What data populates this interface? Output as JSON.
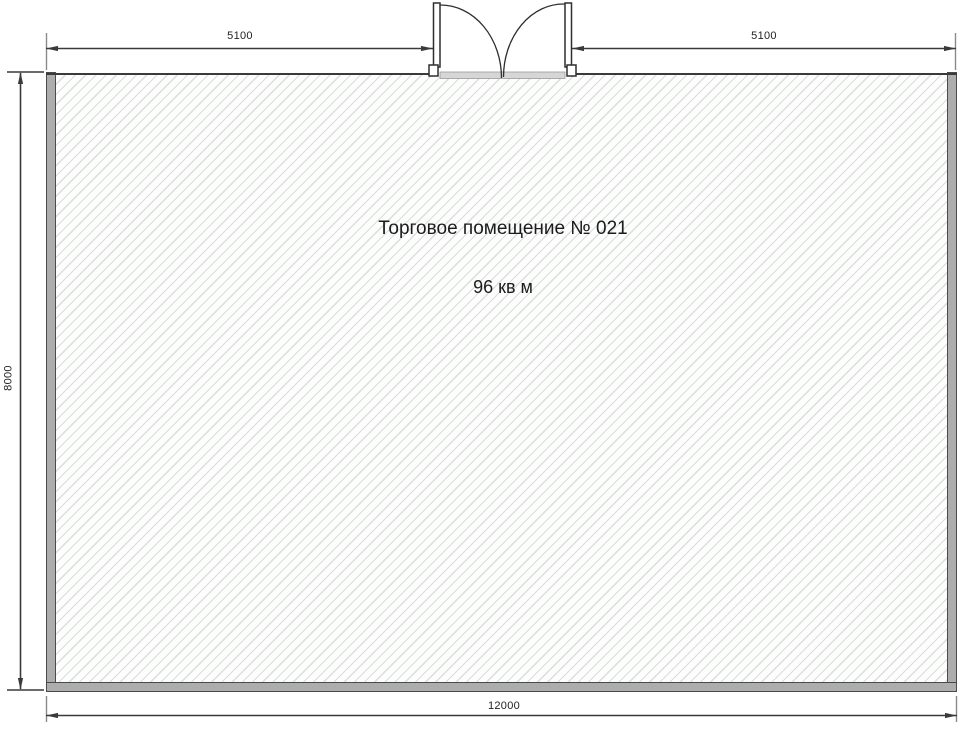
{
  "plan": {
    "title": "Торговое помещение № 021",
    "area": "96 кв м",
    "dimensions": {
      "top_left": "5100",
      "top_right": "5100",
      "left_height": "8000",
      "bottom_width": "12000"
    },
    "colors": {
      "wall_fill": "#adadad",
      "line": "#3a3a3a",
      "hatch_line": "#d8ded8",
      "background": "#ffffff"
    }
  }
}
